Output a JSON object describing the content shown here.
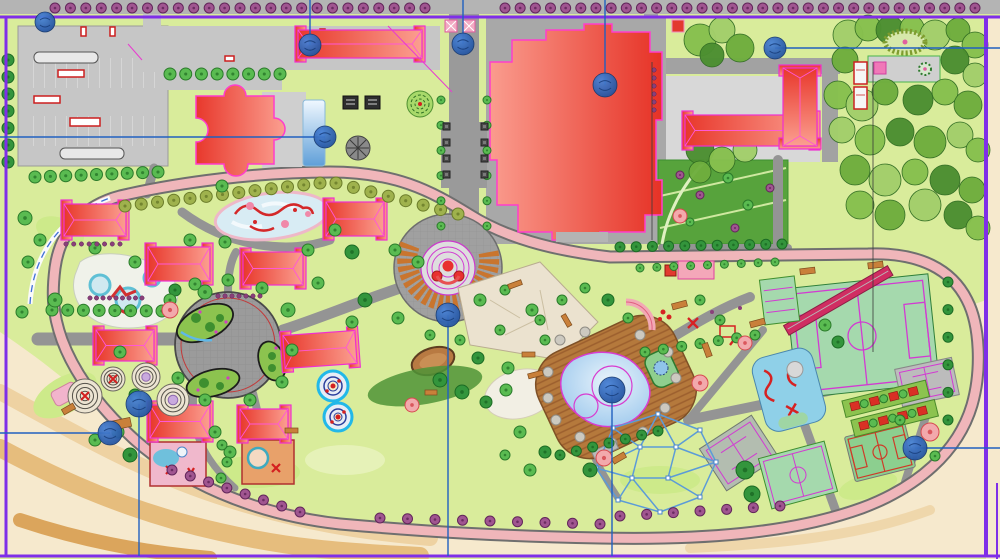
{
  "meta": {
    "title": "Park and resort landscape master plan (CAD presentation drawing)",
    "width": 1000,
    "height": 559
  },
  "palette": {
    "ground": "#d9ec9b",
    "sand": "#f6e9cd",
    "road_fill": "#f0b6ba",
    "road_casing": "#6f6f6f",
    "path_gray": "#949494",
    "plaza_gray": "#a0a0a0",
    "roof_dark": "#e8382c",
    "roof_light": "#fb9f90",
    "building_outline": "#ff3dcc",
    "field_green": "#a5d9ad",
    "court_line": "#d23bd2",
    "lawn_dark": "#57a33c",
    "water": "#8fc0ea",
    "deck_brown": "#b5793c",
    "annotation_blue": "#2060c0",
    "marker_blue": "#2e66b8",
    "frame_purple": "#7f2ee8",
    "amphitheater_orange": "#c9752e"
  },
  "annotations": {
    "frame_lines": [
      [
        0,
        17,
        1000,
        17,
        3
      ],
      [
        6,
        17,
        6,
        556,
        3
      ],
      [
        0,
        556,
        1000,
        556,
        3
      ],
      [
        986,
        17,
        986,
        556,
        4
      ],
      [
        997,
        483,
        997,
        559,
        2
      ]
    ],
    "leader_lines": [
      [
        310,
        0,
        310,
        45
      ],
      [
        463,
        0,
        463,
        44
      ],
      [
        605,
        0,
        605,
        85
      ],
      [
        775,
        48,
        1000,
        48
      ],
      [
        0,
        137,
        325,
        137
      ],
      [
        448,
        315,
        448,
        556
      ],
      [
        612,
        390,
        612,
        556
      ],
      [
        915,
        448,
        1000,
        448
      ],
      [
        139,
        404,
        139,
        556
      ],
      [
        0,
        433,
        110,
        433
      ]
    ],
    "markers": [
      [
        45,
        22,
        10
      ],
      [
        310,
        45,
        11
      ],
      [
        463,
        44,
        11
      ],
      [
        605,
        85,
        12
      ],
      [
        775,
        48,
        11
      ],
      [
        325,
        137,
        11
      ],
      [
        448,
        315,
        12
      ],
      [
        612,
        390,
        13
      ],
      [
        915,
        448,
        12
      ],
      [
        139,
        404,
        13
      ],
      [
        110,
        433,
        12
      ]
    ]
  },
  "buildings": {
    "blocks": [
      [
        64,
        204,
        62,
        32,
        0
      ],
      [
        148,
        247,
        62,
        34,
        0
      ],
      [
        243,
        252,
        60,
        33,
        0
      ],
      [
        326,
        202,
        58,
        34,
        0
      ],
      [
        96,
        330,
        58,
        31,
        0
      ],
      [
        284,
        333,
        72,
        33,
        -4
      ],
      [
        150,
        405,
        60,
        33,
        0
      ],
      [
        240,
        409,
        48,
        30,
        0
      ],
      [
        298,
        30,
        124,
        28,
        0
      ],
      [
        685,
        115,
        132,
        31,
        0
      ],
      [
        761,
        90,
        78,
        34,
        90
      ]
    ]
  },
  "vegetation": {
    "tree_kinds": {
      "std": [
        "#5abb51",
        "#2a7a2a"
      ],
      "dark": [
        "#33953c",
        "#1c6b24"
      ],
      "olive": [
        "#9fb24d",
        "#6b7c2a"
      ],
      "purple": [
        "#a05590",
        "#62265a"
      ],
      "pink": [
        "#f2a9ac",
        "#d6494f"
      ]
    },
    "tree_rows": [
      [
        55,
        8,
        425,
        8,
        25,
        "purple",
        5
      ],
      [
        505,
        8,
        975,
        8,
        32,
        "purple",
        5
      ],
      [
        170,
        74,
        280,
        74,
        8,
        "std",
        6
      ],
      [
        8,
        60,
        8,
        162,
        7,
        "dark",
        6
      ],
      [
        35,
        177,
        158,
        172,
        9,
        "std",
        6
      ],
      [
        125,
        206,
        320,
        183,
        13,
        "olive",
        6
      ],
      [
        336,
        183,
        458,
        214,
        8,
        "olive",
        6
      ],
      [
        441,
        100,
        441,
        226,
        6,
        "std",
        4
      ],
      [
        487,
        100,
        487,
        226,
        6,
        "std",
        4
      ],
      [
        620,
        247,
        782,
        244,
        11,
        "dark",
        5
      ],
      [
        640,
        268,
        775,
        262,
        9,
        "std",
        4
      ],
      [
        172,
        470,
        300,
        512,
        8,
        "purple",
        5
      ],
      [
        380,
        518,
        600,
        524,
        9,
        "purple",
        5
      ],
      [
        620,
        516,
        780,
        506,
        7,
        "purple",
        5
      ],
      [
        560,
        455,
        658,
        431,
        7,
        "dark",
        5
      ],
      [
        645,
        352,
        755,
        335,
        7,
        "std",
        5
      ],
      [
        52,
        310,
        162,
        311,
        8,
        "std",
        6
      ],
      [
        948,
        282,
        948,
        420,
        6,
        "dark",
        5
      ]
    ],
    "tree_singles": [
      [
        25,
        218,
        "std",
        7
      ],
      [
        40,
        240,
        "std",
        6
      ],
      [
        28,
        262,
        "std",
        6
      ],
      [
        55,
        300,
        "std",
        7
      ],
      [
        22,
        312,
        "std",
        6
      ],
      [
        95,
        248,
        "std",
        6
      ],
      [
        135,
        262,
        "std",
        6
      ],
      [
        190,
        240,
        "std",
        6
      ],
      [
        225,
        242,
        "std",
        6
      ],
      [
        308,
        250,
        "std",
        6
      ],
      [
        318,
        283,
        "std",
        6
      ],
      [
        205,
        292,
        "std",
        7
      ],
      [
        175,
        290,
        "dark",
        6
      ],
      [
        222,
        186,
        "std",
        6
      ],
      [
        335,
        230,
        "std",
        6
      ],
      [
        352,
        252,
        "dark",
        7
      ],
      [
        170,
        300,
        "std",
        6
      ],
      [
        195,
        284,
        "std",
        6
      ],
      [
        228,
        280,
        "std",
        6
      ],
      [
        262,
        288,
        "std",
        6
      ],
      [
        288,
        310,
        "std",
        7
      ],
      [
        292,
        350,
        "std",
        6
      ],
      [
        282,
        382,
        "std",
        6
      ],
      [
        250,
        400,
        "std",
        6
      ],
      [
        205,
        400,
        "std",
        6
      ],
      [
        178,
        378,
        "std",
        6
      ],
      [
        120,
        352,
        "std",
        6
      ],
      [
        135,
        395,
        "dark",
        6
      ],
      [
        118,
        432,
        "std",
        6
      ],
      [
        215,
        432,
        "std",
        6
      ],
      [
        230,
        452,
        "std",
        6
      ],
      [
        130,
        455,
        "dark",
        7
      ],
      [
        95,
        440,
        "std",
        6
      ],
      [
        395,
        250,
        "std",
        6
      ],
      [
        418,
        262,
        "std",
        6
      ],
      [
        365,
        300,
        "dark",
        7
      ],
      [
        352,
        322,
        "std",
        6
      ],
      [
        398,
        318,
        "std",
        6
      ],
      [
        430,
        335,
        "std",
        5
      ],
      [
        460,
        340,
        "std",
        5
      ],
      [
        478,
        358,
        "dark",
        6
      ],
      [
        508,
        368,
        "std",
        6
      ],
      [
        540,
        320,
        "std",
        5
      ],
      [
        562,
        300,
        "std",
        5
      ],
      [
        585,
        288,
        "std",
        5
      ],
      [
        608,
        300,
        "dark",
        6
      ],
      [
        628,
        318,
        "std",
        5
      ],
      [
        440,
        380,
        "dark",
        7
      ],
      [
        462,
        392,
        "dark",
        7
      ],
      [
        486,
        402,
        "dark",
        6
      ],
      [
        506,
        390,
        "std",
        6
      ],
      [
        520,
        432,
        "std",
        6
      ],
      [
        545,
        452,
        "dark",
        6
      ],
      [
        530,
        470,
        "std",
        6
      ],
      [
        505,
        455,
        "std",
        5
      ],
      [
        700,
        300,
        "std",
        5
      ],
      [
        720,
        320,
        "std",
        5
      ],
      [
        825,
        325,
        "std",
        6
      ],
      [
        838,
        342,
        "dark",
        6
      ],
      [
        900,
        420,
        "std",
        5
      ],
      [
        935,
        456,
        "std",
        5
      ],
      [
        590,
        470,
        "dark",
        7
      ],
      [
        745,
        470,
        "dark",
        9
      ],
      [
        752,
        494,
        "dark",
        8
      ],
      [
        222,
        445,
        "std",
        5
      ],
      [
        227,
        462,
        "std",
        5
      ],
      [
        221,
        478,
        "std",
        5
      ],
      [
        680,
        175,
        "purple",
        4
      ],
      [
        700,
        195,
        "purple",
        4
      ],
      [
        728,
        178,
        "std",
        5
      ],
      [
        748,
        205,
        "std",
        5
      ],
      [
        770,
        188,
        "purple",
        4
      ],
      [
        690,
        222,
        "std",
        4
      ],
      [
        735,
        228,
        "purple",
        4
      ],
      [
        480,
        300,
        "std",
        6
      ],
      [
        505,
        290,
        "std",
        5
      ],
      [
        532,
        310,
        "std",
        6
      ],
      [
        500,
        330,
        "std",
        5
      ],
      [
        545,
        340,
        "std",
        5
      ],
      [
        170,
        310,
        "pink",
        8
      ],
      [
        680,
        216,
        "pink",
        7
      ],
      [
        700,
        383,
        "pink",
        8
      ],
      [
        930,
        432,
        "pink",
        9
      ],
      [
        412,
        405,
        "pink",
        7
      ],
      [
        604,
        458,
        "pink",
        8
      ],
      [
        745,
        343,
        "pink",
        7
      ]
    ],
    "forest": [
      [
        700,
        40,
        16,
        1
      ],
      [
        722,
        30,
        13,
        2
      ],
      [
        740,
        48,
        14,
        0
      ],
      [
        712,
        55,
        12,
        3
      ],
      [
        848,
        35,
        15,
        2
      ],
      [
        868,
        28,
        13,
        1
      ],
      [
        890,
        30,
        14,
        3
      ],
      [
        912,
        28,
        12,
        1
      ],
      [
        935,
        35,
        15,
        2
      ],
      [
        958,
        30,
        12,
        0
      ],
      [
        975,
        45,
        13,
        1
      ],
      [
        845,
        60,
        13,
        0
      ],
      [
        955,
        60,
        14,
        3
      ],
      [
        975,
        75,
        12,
        2
      ],
      [
        838,
        95,
        14,
        1
      ],
      [
        862,
        105,
        16,
        2
      ],
      [
        885,
        92,
        13,
        0
      ],
      [
        918,
        100,
        15,
        3
      ],
      [
        945,
        92,
        13,
        1
      ],
      [
        968,
        105,
        14,
        0
      ],
      [
        842,
        130,
        13,
        2
      ],
      [
        870,
        140,
        15,
        1
      ],
      [
        900,
        132,
        14,
        3
      ],
      [
        930,
        142,
        16,
        0
      ],
      [
        960,
        135,
        13,
        2
      ],
      [
        978,
        150,
        12,
        1
      ],
      [
        855,
        170,
        15,
        0
      ],
      [
        885,
        180,
        16,
        2
      ],
      [
        915,
        172,
        13,
        1
      ],
      [
        945,
        180,
        15,
        3
      ],
      [
        972,
        190,
        13,
        0
      ],
      [
        860,
        205,
        14,
        1
      ],
      [
        890,
        215,
        15,
        0
      ],
      [
        925,
        205,
        16,
        2
      ],
      [
        958,
        215,
        14,
        3
      ],
      [
        978,
        228,
        12,
        1
      ],
      [
        700,
        150,
        14,
        3
      ],
      [
        722,
        160,
        13,
        1
      ],
      [
        745,
        150,
        12,
        2
      ],
      [
        700,
        172,
        11,
        0
      ]
    ],
    "forest_colors": [
      "#6fae3e",
      "#87c04e",
      "#a3cf6b",
      "#4c8f31"
    ],
    "hedge_rows": [
      [
        90,
        298,
        142,
        298,
        9
      ],
      [
        66,
        244,
        120,
        244,
        8
      ],
      [
        218,
        296,
        260,
        296,
        7
      ],
      [
        654,
        70,
        654,
        110,
        6
      ]
    ]
  },
  "features": {
    "spiral_mounds": [
      [
        85,
        396,
        17,
        "red"
      ],
      [
        113,
        379,
        12,
        "red"
      ],
      [
        146,
        377,
        14,
        "lav"
      ],
      [
        173,
        400,
        16,
        "lav"
      ]
    ],
    "spiral_pads": [
      [
        333,
        386,
        15
      ],
      [
        338,
        417,
        14
      ]
    ],
    "rope_web": {
      "nodes": [
        [
          613,
          428
        ],
        [
          658,
          414
        ],
        [
          700,
          430
        ],
        [
          716,
          462
        ],
        [
          700,
          497
        ],
        [
          660,
          512
        ],
        [
          618,
          500
        ],
        [
          596,
          468
        ],
        [
          640,
          447
        ],
        [
          676,
          447
        ],
        [
          668,
          478
        ],
        [
          632,
          478
        ]
      ],
      "edges": [
        [
          0,
          1
        ],
        [
          1,
          2
        ],
        [
          2,
          3
        ],
        [
          3,
          4
        ],
        [
          4,
          5
        ],
        [
          5,
          6
        ],
        [
          6,
          7
        ],
        [
          7,
          0
        ],
        [
          0,
          8
        ],
        [
          1,
          8
        ],
        [
          7,
          8
        ],
        [
          1,
          9
        ],
        [
          2,
          9
        ],
        [
          3,
          9
        ],
        [
          8,
          9
        ],
        [
          9,
          10
        ],
        [
          3,
          10
        ],
        [
          4,
          10
        ],
        [
          10,
          11
        ],
        [
          5,
          11
        ],
        [
          6,
          11
        ],
        [
          7,
          11
        ],
        [
          8,
          11
        ]
      ]
    },
    "furniture": [
      [
        508,
        282,
        14,
        5,
        -20
      ],
      [
        560,
        318,
        13,
        5,
        60
      ],
      [
        522,
        352,
        13,
        5,
        0
      ],
      [
        528,
        372,
        15,
        5,
        -15
      ],
      [
        425,
        390,
        12,
        5,
        0
      ],
      [
        285,
        428,
        13,
        5,
        0
      ],
      [
        800,
        268,
        15,
        6,
        -7
      ],
      [
        868,
        262,
        15,
        6,
        -7
      ],
      [
        672,
        302,
        15,
        6,
        -15
      ],
      [
        750,
        320,
        15,
        6,
        -15
      ],
      [
        700,
        347,
        14,
        6,
        70
      ],
      [
        62,
        406,
        13,
        6,
        -30
      ],
      [
        105,
        420,
        26,
        9,
        -12
      ],
      [
        612,
        455,
        14,
        6,
        -30
      ]
    ],
    "planters": {
      "xs": [
        443,
        481
      ],
      "ys": [
        123,
        139,
        155,
        171
      ],
      "size": 7
    }
  }
}
